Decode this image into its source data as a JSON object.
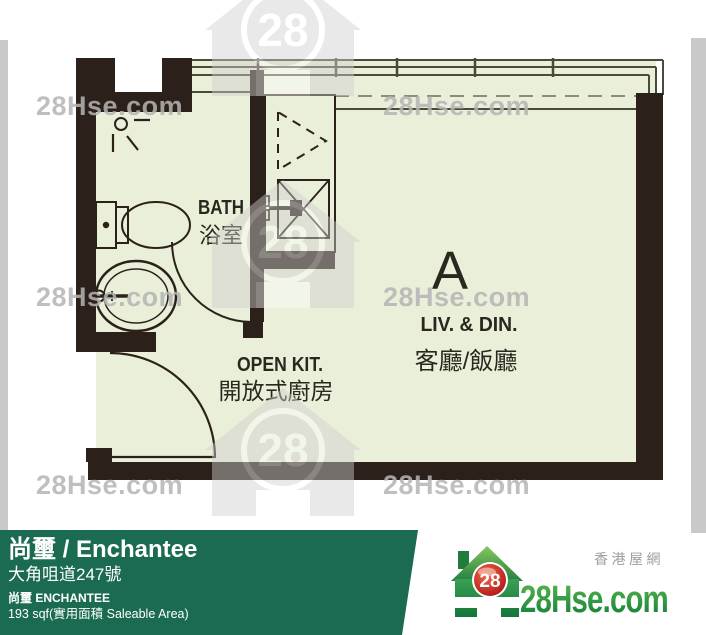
{
  "floorplan": {
    "unit_label": "A",
    "rooms": {
      "bath": {
        "en": "BATH",
        "zh": "浴室"
      },
      "open_kitchen": {
        "en": "OPEN KIT.",
        "zh": "開放式廚房"
      },
      "living_dining": {
        "en": "LIV. & DIN.",
        "zh": "客廳/飯廳"
      }
    }
  },
  "watermark": {
    "text": "28Hse.com",
    "badge": "28"
  },
  "footer": {
    "title": "尚璽 / Enchantee",
    "address": "大角咀道247號",
    "subtitle": "尚璽  ENCHANTEE",
    "area": "193 sqf(實用面積 Saleable Area)",
    "brand": {
      "site_zh": "香港屋網",
      "logo_text": "28Hse.com",
      "logo_badge": "28"
    }
  },
  "colors": {
    "footer_green": "#1a6b51",
    "plan_floor": "#e9efd8",
    "wall": "#2c211a",
    "watermark_gray": "#cfcfcf",
    "logo_red": "#c8161d",
    "logo_green": "#1e8a40",
    "side_strip": "#c9c9c9"
  }
}
